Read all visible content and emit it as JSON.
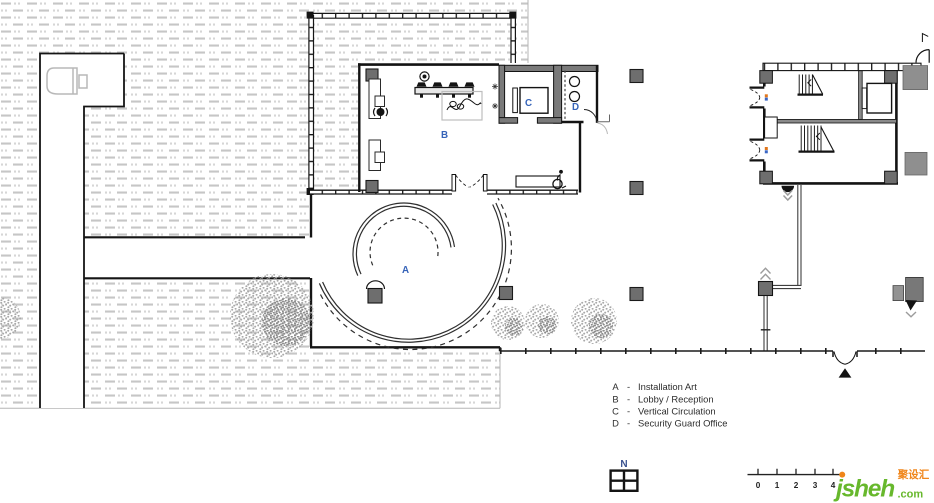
{
  "plan": {
    "room_labels": {
      "a": "A",
      "b": "B",
      "c": "C",
      "d": "D"
    },
    "legend": {
      "items": [
        {
          "key": "A",
          "sep": "-",
          "label": "Installation Art"
        },
        {
          "key": "B",
          "sep": "-",
          "label": "Lobby / Reception"
        },
        {
          "key": "C",
          "sep": "-",
          "label": "Vertical Circulation"
        },
        {
          "key": "D",
          "sep": "-",
          "label": "Security Guard Office"
        }
      ]
    },
    "north_label": "N",
    "scale_bar": {
      "tick_labels": [
        "0",
        "1",
        "2",
        "3",
        "4"
      ]
    }
  },
  "branding": {
    "logo_name": "jsheh",
    "logo_tld": ".com",
    "logo_badge": "聚设汇",
    "green": "#67b82c",
    "orange": "#f08519"
  },
  "colors": {
    "wall": "#1b1b1b",
    "gray_wall": "#7a7a7a",
    "column": "#6e6e6e",
    "label_blue": "#3563b8",
    "hatch": "#c6c6c6"
  }
}
